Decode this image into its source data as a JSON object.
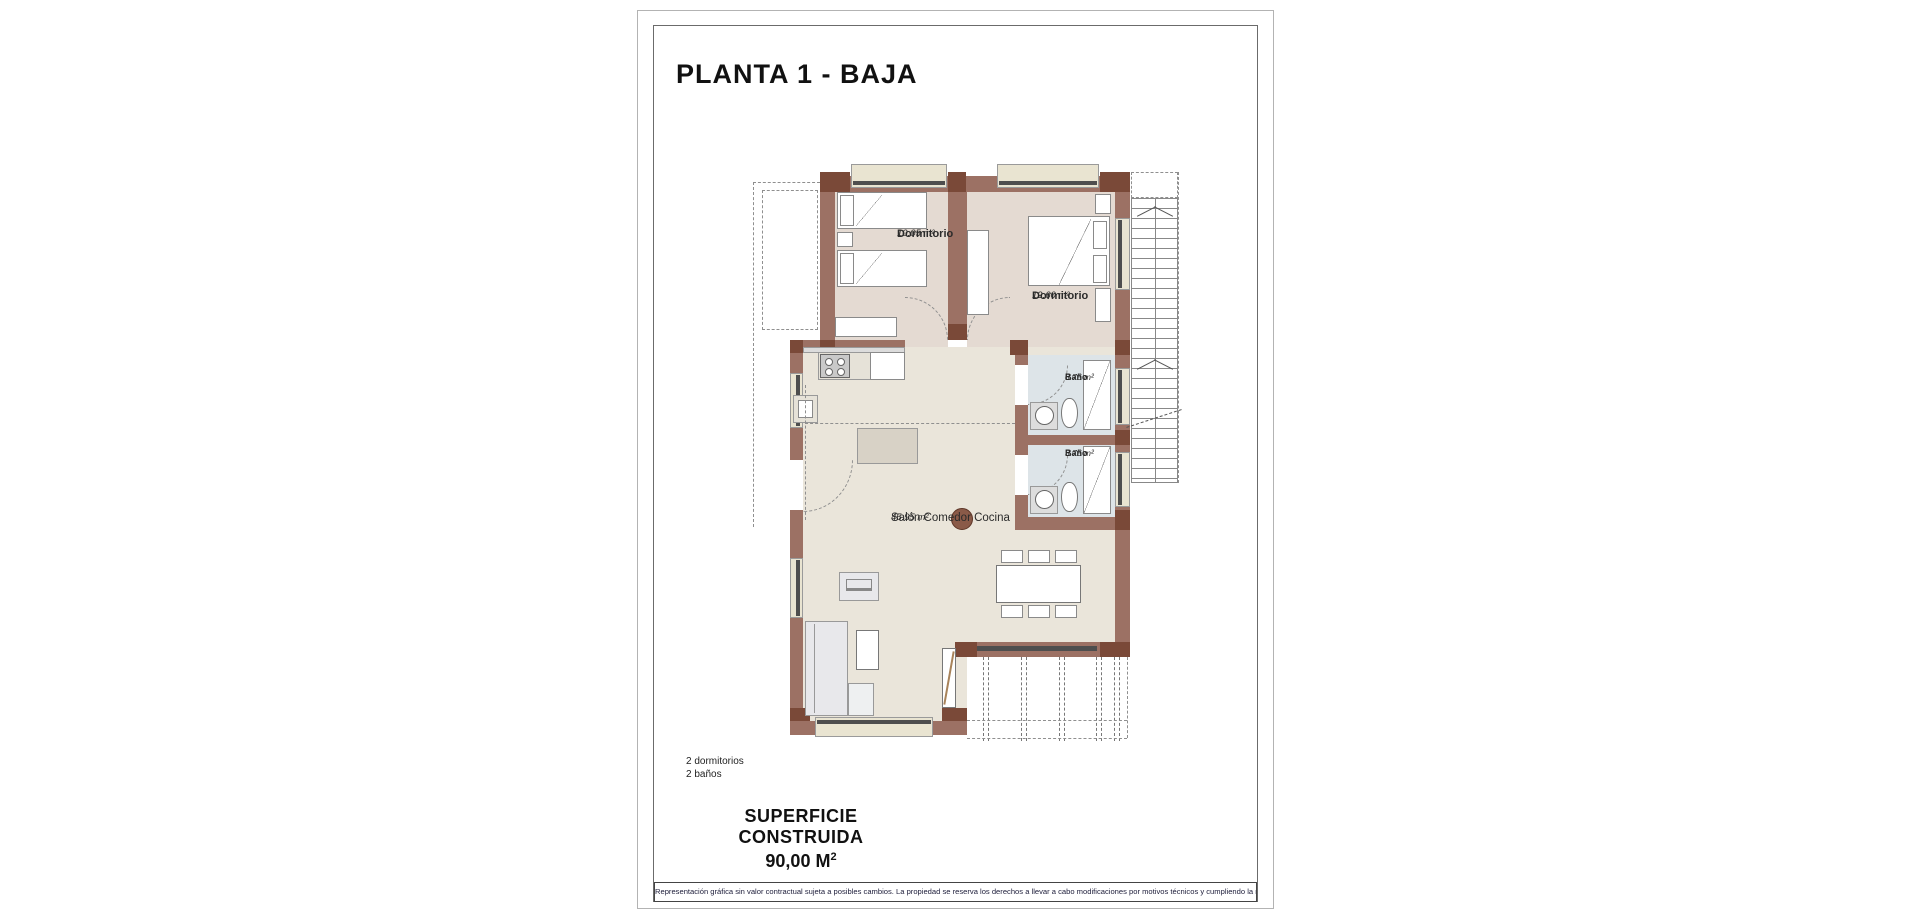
{
  "title": "PLANTA 1 - BAJA",
  "rooms": [
    {
      "name": "Dormitorio",
      "area": "10.05 m²"
    },
    {
      "name": "Dormitorio",
      "area": "12.60 m²"
    },
    {
      "name": "Baño",
      "area": "3.75 m²"
    },
    {
      "name": "Baño",
      "area": "3.75 m²"
    },
    {
      "name": "Salón Comedor Cocina",
      "area": "45.95 m²"
    }
  ],
  "summary": {
    "bedrooms": "2 dormitorios",
    "bathrooms": "2 baños"
  },
  "surface": {
    "label": "SUPERFICIE CONSTRUIDA",
    "value": "90,00 M",
    "sup": "2"
  },
  "disclaimer": "Representación gráfica sin valor contractual sujeta a posibles cambios. La propiedad se reserva los derechos a llevar a cabo modificaciones por motivos técnicos y cumpliendo la normativa vigente.",
  "colors": {
    "wall": "#9c7164",
    "wall_dark": "#7a4938",
    "bedroom_floor": "#e4dad2",
    "living_floor": "#eae5da",
    "bath_floor": "#dde4e8",
    "window_sill": "#e9e4d1",
    "accent_column": "#8a5a48"
  }
}
